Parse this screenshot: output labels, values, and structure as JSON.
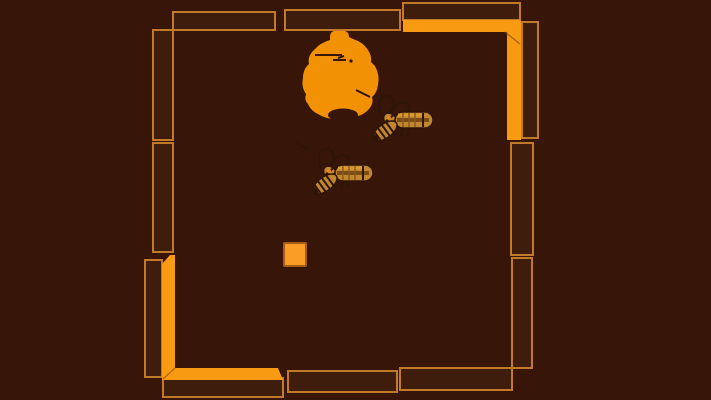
{
  "screen": {
    "name": "insect-arena-game-screen",
    "width": 711,
    "height": 400
  },
  "colors": {
    "background": "#371609",
    "wall_fill": "#3E1D0C",
    "wall_stroke": "#C07A28",
    "bracket_orange": "#F89B12",
    "seam_color": "#8A4A08",
    "hive_orange": "#F29104",
    "square_orange": "#F99D26",
    "square_rim": "#A85E10",
    "wasp_gold": "#C28631",
    "wasp_shade": "#7A4D15",
    "wasp_outline": "#2E1507"
  },
  "walls": {
    "outlined_blocks": [
      {
        "id": "top-left-block",
        "x": 173,
        "y": 12,
        "w": 102,
        "h": 18
      },
      {
        "id": "top-middle-block",
        "x": 285,
        "y": 10,
        "w": 115,
        "h": 20
      },
      {
        "id": "top-right-block",
        "x": 403,
        "y": 3,
        "w": 117,
        "h": 17
      },
      {
        "id": "right-upper-side-block",
        "x": 522,
        "y": 22,
        "w": 16,
        "h": 116
      },
      {
        "id": "right-middle-block",
        "x": 511,
        "y": 143,
        "w": 22,
        "h": 112
      },
      {
        "id": "right-lower-block",
        "x": 512,
        "y": 258,
        "w": 20,
        "h": 110
      },
      {
        "id": "bottom-right-block",
        "x": 400,
        "y": 368,
        "w": 112,
        "h": 22
      },
      {
        "id": "bottom-middle-block",
        "x": 288,
        "y": 371,
        "w": 109,
        "h": 21
      },
      {
        "id": "bottom-left-block",
        "x": 163,
        "y": 378,
        "w": 120,
        "h": 19
      },
      {
        "id": "left-lower-side-block",
        "x": 145,
        "y": 260,
        "w": 17,
        "h": 117
      },
      {
        "id": "left-middle-block",
        "x": 153,
        "y": 143,
        "w": 20,
        "h": 109
      },
      {
        "id": "left-upper-block",
        "x": 153,
        "y": 30,
        "w": 20,
        "h": 110
      }
    ],
    "brackets": [
      {
        "id": "top-right-bracket",
        "points": "403,20 521,20 521,140 507,140 507,32 403,32",
        "seam": "505,32 520,44"
      },
      {
        "id": "bottom-left-bracket",
        "points": "162,264 170,255 175,255 175,368 278,368 283,380 162,380",
        "seam": "175,368 163,379"
      }
    ]
  },
  "entities": {
    "hive": {
      "id": "beehive",
      "x": 303,
      "y": 31
    },
    "wasps": [
      {
        "id": "wasp-1",
        "x": 367,
        "y": 94
      },
      {
        "id": "wasp-2",
        "x": 307,
        "y": 147
      }
    ],
    "player_square": {
      "id": "player-block",
      "x": 284,
      "y": 243,
      "w": 22,
      "h": 23
    }
  }
}
